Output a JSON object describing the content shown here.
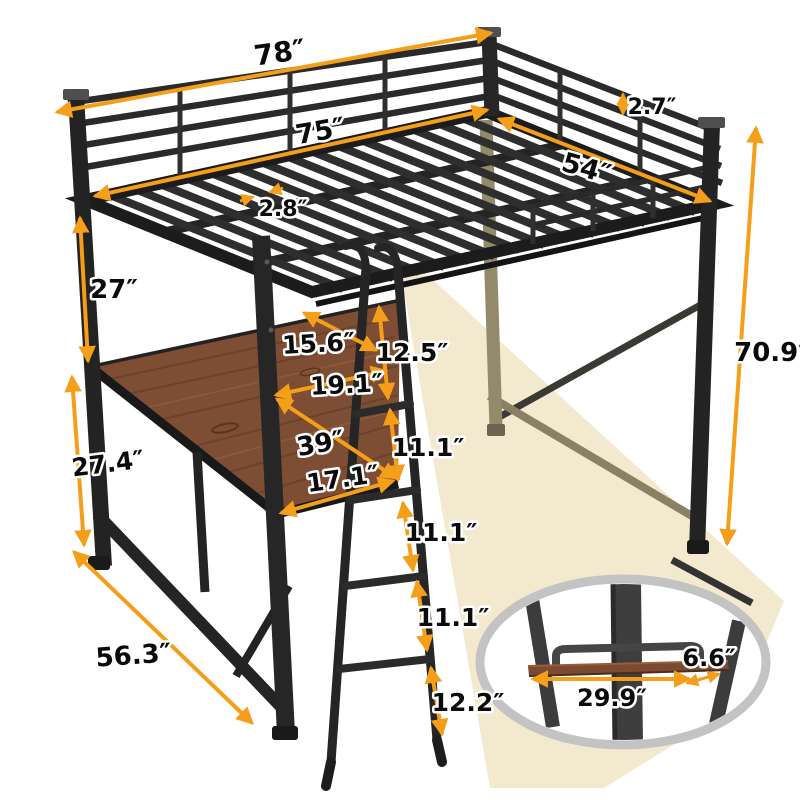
{
  "diagram_title": "loft-bed-with-desk-dimension-diagram",
  "dimensions": {
    "overall_length": "78″",
    "guardrail_bar_gap": "2.7″",
    "inner_length": "75″",
    "bed_width": "54″",
    "slat_gap": "2.8″",
    "under_bed_clearance": "27″",
    "overall_height": "70.9″",
    "post_to_ladder_gap": "15.6″",
    "desk_clearance": "19.1″",
    "desk_length": "39″",
    "desk_depth": "17.1″",
    "ladder_spacing_1": "12.5″",
    "ladder_spacing_2": "11.1″",
    "ladder_spacing_3": "11.1″",
    "ladder_spacing_4": "11.1″",
    "ladder_spacing_5": "12.2″",
    "desk_height": "27.4″",
    "base_depth": "56.3″",
    "shelf_length": "29.9″",
    "shelf_depth": "6.6″"
  },
  "colors": {
    "accent_arrow": "#F59E19",
    "frame_black": "#2B2B2B",
    "wood_brown": "#7D4E33",
    "light_beam": "#F2E9CE",
    "callout_ring": "#C3C3C3",
    "highlight_tan": "#93896B"
  }
}
